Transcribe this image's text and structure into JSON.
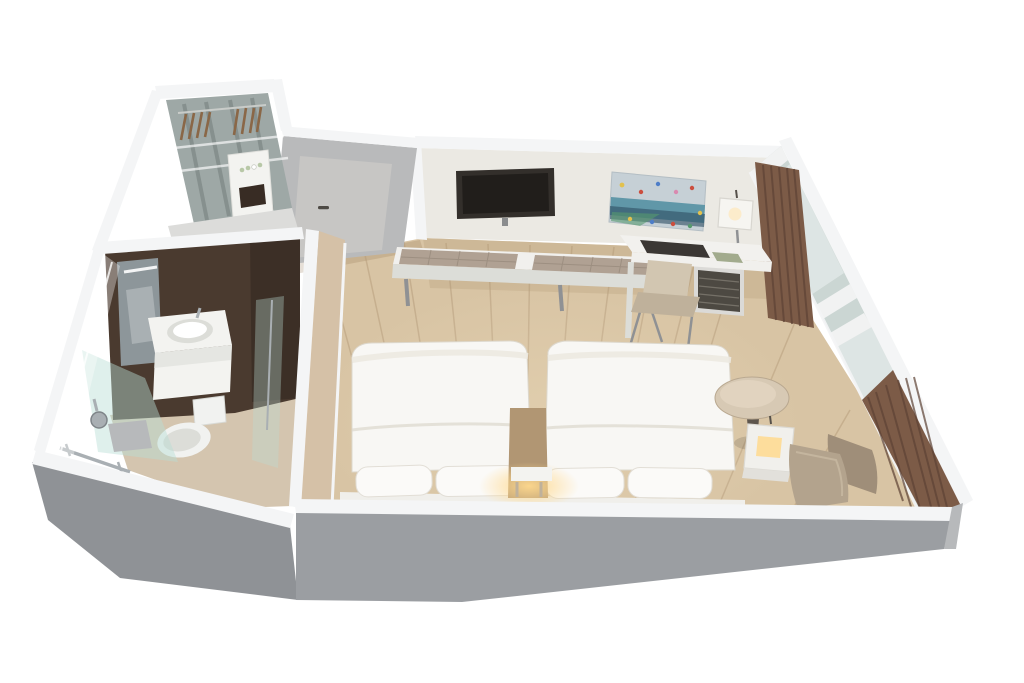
{
  "scene": {
    "type": "3d-floor-plan-render",
    "subject": "hotel-guestroom-cutaway",
    "view": "isometric-cutaway",
    "background": "#ffffff"
  },
  "rooms": {
    "bedroom": {
      "label": "bedroom",
      "objects": [
        "twin-bed-left",
        "twin-bed-right",
        "center-nightstand-lamp",
        "wall-tv",
        "abstract-artwork",
        "luggage-bench",
        "work-desk",
        "desk-lamp",
        "desk-chair",
        "minibar",
        "round-side-table",
        "cube-lamp-table",
        "armchair",
        "window-wall",
        "curtains",
        "wood-floor"
      ]
    },
    "bathroom": {
      "label": "bathroom",
      "objects": [
        "vanity-mirror",
        "sink",
        "toilet",
        "walk-in-shower",
        "shower-head",
        "towel-rail",
        "glass-outer-wall",
        "accent-wall"
      ]
    },
    "closet": {
      "label": "closet",
      "objects": [
        "clothes-hangers",
        "amenity-shelf",
        "glass-shelves"
      ]
    },
    "entry": {
      "label": "entry",
      "objects": [
        "entry-door"
      ]
    }
  },
  "colors": {
    "background": "#ffffff",
    "rim_white": "#f4f5f6",
    "rim_shade": "#e2e3e4",
    "gray_wall": "#9b9ea2",
    "gray_wall_dark": "#8f9296",
    "gray_wall_light": "#b7b9bb",
    "entry_wall": "#b9babb",
    "door_panel": "#c7c6c4",
    "door_handle": "#4e4a45",
    "cream_wall": "#ebe9e3",
    "closet_south_wall": "#dcdcda",
    "partition_tan": "#d5c1a7",
    "wood_floor": "#d8c4a4",
    "wood_floor_dark": "#c2aa88",
    "wood_floor_light": "#ecdbba",
    "plank_seam": "#b39a79",
    "corridor_shade": "#8b6c4b",
    "bath_floor": "#d4c5af",
    "accent_brown": "#4a3a2f",
    "accent_brown_dark": "#382c24",
    "mirror_glass": "#8d969a",
    "fixture_white": "#f3f3f0",
    "fixture_shade": "#dcddd8",
    "chrome": "#a9afb3",
    "shower_glass": "#b9ded5",
    "glass_pale": "#dce5e2",
    "window_glass": "#cbd6d3",
    "window_glass_light": "#e1e8e6",
    "mullion": "#f1f2f2",
    "curtain": "#7c5b47",
    "curtain_dark": "#5d4235",
    "tv_screen": "#332f2b",
    "tv_screen_dark": "#211e1b",
    "tv_mount": "#8a8c8e",
    "art_bg": "#c6d0d6",
    "art_teal": "#4e8da0",
    "art_navy": "#2e4e62",
    "art_green": "#569a6e",
    "art_red": "#cb4e3e",
    "art_yellow": "#e2c14e",
    "art_blue": "#4e7ec8",
    "art_pink": "#d98ab0",
    "bench_white": "#f1f0ed",
    "bench_pad": "#b0a193",
    "pad_seam": "#998b7d",
    "leg_gray": "#8f9194",
    "desk_white": "#f2f1ee",
    "desk_inset": "#3b3734",
    "desk_tray": "#a2ab8d",
    "lamp_shade": "#f6f5f1",
    "lamp_glow": "#ffe7b7",
    "minibar_dark": "#4d4942",
    "minibar_frame": "#dbdad7",
    "chair_beige": "#d2c6b1",
    "chair_beige_dark": "#bfb19b",
    "bed_white": "#f8f7f4",
    "bed_fold": "#ece9e1",
    "bed_edge": "#dcd7cc",
    "pillow_white": "#fbfaf8",
    "headboard_white": "#f0efeb",
    "night_wood": "#b19673",
    "glow_warm": "#ffd98e",
    "table_top": "#d7c9b4",
    "table_top_light": "#e3d6c2",
    "table_base": "#5e564d",
    "cube_white": "#f1f0ec",
    "cube_face": "#e2e0db",
    "armchair_taupe": "#b3a38d",
    "armchair_taupe_dark": "#9f8e79",
    "hanger_brown": "#8a6747",
    "closet_mirror": "#9ea8a6",
    "closet_mirror_dark": "#6f7977",
    "amenity_green": "#b8c8a7",
    "toilet_white": "#f1f2f0",
    "soft_shadow": "rgba(0,0,0,0.12)"
  }
}
